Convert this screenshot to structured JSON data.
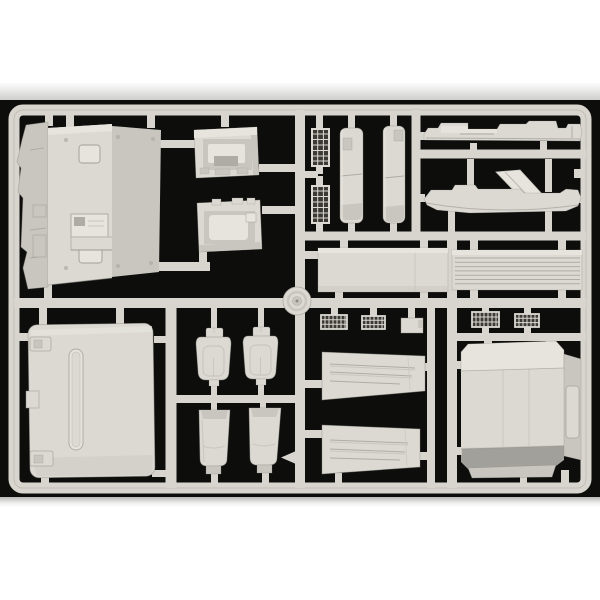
{
  "scene": {
    "type": "product-photograph",
    "subject": "injection-molded plastic model kit sprue (runner frame) holding light gray truck cab parts, photographed on a black background with a white backdrop border",
    "visible_text": "",
    "background": "black",
    "page_background": "white"
  },
  "palette": {
    "page_bg": "#ffffff",
    "photo_black": "#0d0d0c",
    "backdrop_gray": "#d2d2cf",
    "backdrop_gray_bottom": "#bdbdba",
    "runner": "#d7d5ce",
    "runner_shadow": "#97958c",
    "part_face": "#dbd9d2",
    "part_light": "#e6e4dd",
    "part_mid": "#c8c6bf",
    "part_dark": "#aeaca5",
    "part_deep": "#8d8b84",
    "hole_dark": "#3a3934"
  },
  "parts": [
    {
      "id": "cab-floor-assembly",
      "label": "large cab floor / engine tunnel assembly (top left)"
    },
    {
      "id": "dashboard-upper",
      "label": "dashboard panel with recessed opening (upper)"
    },
    {
      "id": "dashboard-lower",
      "label": "dashboard panel with recessed window (lower)"
    },
    {
      "id": "ladder-grille-1",
      "label": "small vertical grid / step grille"
    },
    {
      "id": "ladder-grille-2",
      "label": "small vertical grid / step grille"
    },
    {
      "id": "side-fairing-1",
      "label": "long narrow side fairing panel"
    },
    {
      "id": "side-fairing-2",
      "label": "long narrow side fairing panel"
    },
    {
      "id": "roof-deflector-strip",
      "label": "stepped roof deflector strip (top right)"
    },
    {
      "id": "fender-hull",
      "label": "long hull-shaped fender piece with bent bracket"
    },
    {
      "id": "smooth-panel",
      "label": "smooth rectangular panel (middle)"
    },
    {
      "id": "louvered-panel",
      "label": "rectangular panel with horizontal louvers"
    },
    {
      "id": "steering-wheel",
      "label": "round wheel part at runner junction"
    },
    {
      "id": "cab-rear-panel",
      "label": "large cab rear panel with center rib (bottom left)"
    },
    {
      "id": "seat-backrest-left",
      "label": "seat backrest with headrest"
    },
    {
      "id": "seat-backrest-right",
      "label": "seat backrest with headrest"
    },
    {
      "id": "seat-base-left",
      "label": "seat base cushion"
    },
    {
      "id": "seat-base-right",
      "label": "seat base cushion"
    },
    {
      "id": "vent-grille-1",
      "label": "small ribbed vent grille"
    },
    {
      "id": "vent-grille-2",
      "label": "small ribbed vent grille"
    },
    {
      "id": "vent-grille-3",
      "label": "small ribbed vent grille"
    },
    {
      "id": "vent-grille-4",
      "label": "small ribbed vent grille"
    },
    {
      "id": "small-plate",
      "label": "small rectangular plate"
    },
    {
      "id": "ribbed-mudflap-upper",
      "label": "ribbed tapered mud flap panel (upper)"
    },
    {
      "id": "ribbed-mudflap-lower",
      "label": "ribbed tapered mud flap panel (lower)"
    },
    {
      "id": "floor-panel-large",
      "label": "large floor panel with side bar and handle (bottom right)"
    },
    {
      "id": "sprue-frame",
      "label": "light gray runner frame and connecting sprue gates"
    }
  ]
}
